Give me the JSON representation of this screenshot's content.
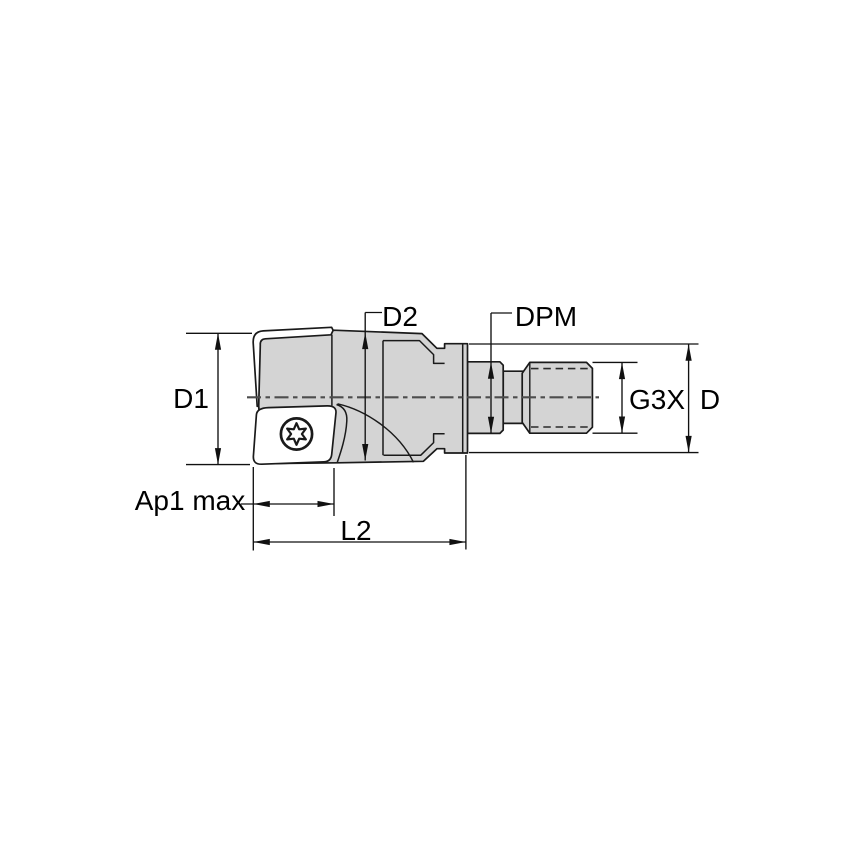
{
  "diagram": {
    "type": "technical-drawing",
    "description": "Side view of an indexable shoulder end mill with screw-clamped insert and modular threaded adapter, annotated with dimension callouts",
    "colors": {
      "background": "#ffffff",
      "body_fill": "#d4d4d4",
      "insert_fill": "#ffffff",
      "outline": "#1a1a1a",
      "dimension_line": "#111111",
      "centerline": "#4d4d4d"
    },
    "labels": {
      "d1": "D1",
      "d2": "D2",
      "dpm": "DPM",
      "g3x": "G3X",
      "d": "D",
      "ap1_max": "Ap1 max",
      "l2": "L2"
    }
  }
}
